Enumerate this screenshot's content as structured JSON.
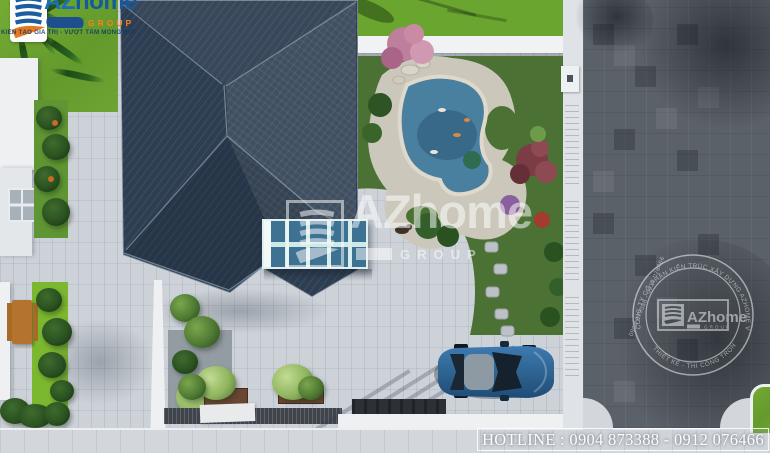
{
  "brand": {
    "az": "AZ",
    "home": "home",
    "group": "GROUP",
    "slogan": "KIẾN TẠO GIÁ TRỊ - VƯỢT TẦM MONG ĐỢI"
  },
  "watermark": {
    "az": "AZ",
    "home": "home",
    "group": "GROUP"
  },
  "stamp": {
    "arc_top": "CÔNG TY CỔ PHẦN KIẾN TRÚC XÂY DỰNG AZHOME VIỆT NAM",
    "arc_bottom": "THIẾT KẾ - THI CÔNG TRỌN GÓI",
    "arc_phone": "0904 873388 - 0912 076466",
    "az": "AZ",
    "home": "home",
    "group": "GROUP"
  },
  "footer": {
    "hotline": "HOTLINE : 0904 873388 - 0912 076466"
  },
  "colors": {
    "roof": "#2e3e52",
    "pond": "#497f9f",
    "lawn": "#6fa433",
    "garden": "#4c7134",
    "paving": "#cdd2d8",
    "road": "#5b6168",
    "car": "#2f6492",
    "stone": "#cbc7bb",
    "logo_blue": "#1b6fb5",
    "logo_navy": "#1c4f8e",
    "logo_orange": "#f5821f"
  }
}
